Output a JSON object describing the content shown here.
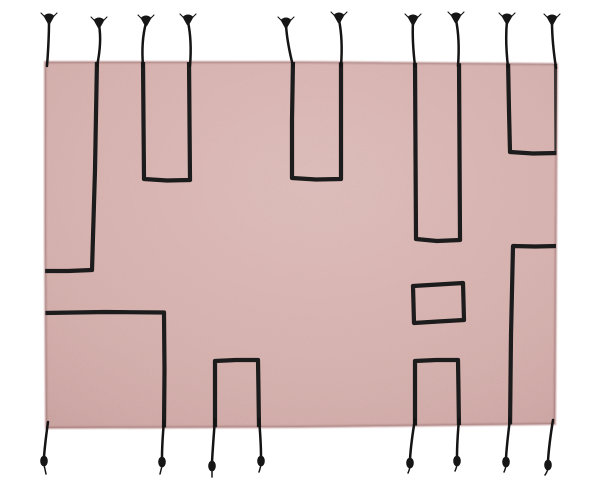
{
  "scene": {
    "description": "Product photograph of a rectangular dusty-pink wool rug with a hand-drawn black geometric line pattern (vertical U-shapes, hooks and a small rectangle) and black braided tassels along the top and bottom edges, on a plain white background",
    "background_color": "#ffffff",
    "rug": {
      "fill_color": "#d8b2af",
      "edge_color": "#c39d9c",
      "shade_color": "#5a2e2e",
      "outline": [
        [
          45,
          62
        ],
        [
          300,
          62
        ],
        [
          557,
          64
        ],
        [
          556,
          240
        ],
        [
          555,
          424
        ],
        [
          300,
          427
        ],
        [
          46,
          428
        ],
        [
          45,
          245
        ]
      ]
    },
    "pattern": {
      "line_color": "#1a1a1a",
      "line_width": 4.2,
      "lines": [
        {
          "name": "left-long-hook",
          "points": [
            [
              97,
              60
            ],
            [
              95,
              170
            ],
            [
              92,
              270
            ],
            [
              68,
              271
            ],
            [
              44,
              271
            ]
          ]
        },
        {
          "name": "u-shape-top-1",
          "points": [
            [
              143,
              60
            ],
            [
              143.5,
              120
            ],
            [
              144,
              179
            ],
            [
              167,
              180.5
            ],
            [
              190,
              180
            ],
            [
              189.5,
              120
            ],
            [
              189,
              60
            ]
          ]
        },
        {
          "name": "u-shape-top-2",
          "points": [
            [
              293,
              60
            ],
            [
              292,
              120
            ],
            [
              292,
              178
            ],
            [
              316,
              179.5
            ],
            [
              341,
              179
            ],
            [
              341,
              120
            ],
            [
              341,
              60
            ]
          ]
        },
        {
          "name": "u-shape-top-3",
          "points": [
            [
              415,
              60
            ],
            [
              415.5,
              150
            ],
            [
              416,
              239
            ],
            [
              437,
              241
            ],
            [
              460,
              240
            ],
            [
              459.5,
              150
            ],
            [
              459,
              60
            ]
          ]
        },
        {
          "name": "top-right-hook",
          "points": [
            [
              508,
              60
            ],
            [
              509,
              110
            ],
            [
              510,
              152
            ],
            [
              533,
              153.5
            ],
            [
              558,
              153
            ]
          ]
        },
        {
          "name": "right-edge-leg",
          "points": [
            [
              556,
              63
            ],
            [
              556.5,
              152
            ]
          ],
          "opacity": 0.8
        },
        {
          "name": "right-mid-hook",
          "points": [
            [
              558,
              246
            ],
            [
              535,
              246.5
            ],
            [
              513,
              246
            ],
            [
              511,
              335
            ],
            [
              510,
              428
            ]
          ]
        },
        {
          "name": "small-rectangle",
          "closed": true,
          "points": [
            [
              413,
              286
            ],
            [
              438,
              284.5
            ],
            [
              463,
              283
            ],
            [
              463.5,
              301
            ],
            [
              464,
              320
            ],
            [
              438,
              321.5
            ],
            [
              414,
              323
            ],
            [
              413.5,
              304
            ]
          ]
        },
        {
          "name": "left-mid-hook",
          "points": [
            [
              44,
              313
            ],
            [
              105,
              312
            ],
            [
              164,
              312.5
            ],
            [
              164.5,
              370
            ],
            [
              164,
              430
            ]
          ]
        },
        {
          "name": "bottom-arch-left",
          "points": [
            [
              215,
              428
            ],
            [
              215,
              390
            ],
            [
              215,
              361
            ],
            [
              236,
              360
            ],
            [
              258,
              360
            ],
            [
              258.5,
              392
            ],
            [
              259,
              428
            ]
          ]
        },
        {
          "name": "bottom-arch-mid",
          "points": [
            [
              415,
              428
            ],
            [
              415,
              390
            ],
            [
              415,
              361
            ],
            [
              436,
              360
            ],
            [
              458,
              360
            ],
            [
              458.5,
              392
            ],
            [
              459,
              428
            ]
          ]
        }
      ]
    },
    "tassels": {
      "color": "#141414",
      "thread_width": 2.5,
      "top": [
        {
          "base_x": 47,
          "base_y": 63,
          "tip_x": 49,
          "tip_y": 17,
          "bend": 2
        },
        {
          "base_x": 97,
          "base_y": 63,
          "tip_x": 99,
          "tip_y": 21,
          "bend": 5
        },
        {
          "base_x": 143,
          "base_y": 63,
          "tip_x": 146,
          "tip_y": 19,
          "bend": -2
        },
        {
          "base_x": 190,
          "base_y": 63,
          "tip_x": 188,
          "tip_y": 18,
          "bend": 2
        },
        {
          "base_x": 293,
          "base_y": 63,
          "tip_x": 286,
          "tip_y": 21,
          "bend": -6
        },
        {
          "base_x": 341,
          "base_y": 63,
          "tip_x": 339,
          "tip_y": 16,
          "bend": 2
        },
        {
          "base_x": 415,
          "base_y": 63,
          "tip_x": 413,
          "tip_y": 18,
          "bend": -3
        },
        {
          "base_x": 458,
          "base_y": 63,
          "tip_x": 456,
          "tip_y": 16,
          "bend": 2
        },
        {
          "base_x": 508,
          "base_y": 64,
          "tip_x": 507,
          "tip_y": 17,
          "bend": -3
        },
        {
          "base_x": 556,
          "base_y": 65,
          "tip_x": 552,
          "tip_y": 18,
          "bend": -4
        }
      ],
      "bottom": [
        {
          "base_x": 48,
          "base_y": 426,
          "knot_x": 44,
          "knot_y": 461,
          "bend": -3,
          "tail_x": 46,
          "tail_y": 474
        },
        {
          "base_x": 164,
          "base_y": 425,
          "knot_x": 162,
          "knot_y": 462,
          "bend": -2,
          "tail_x": 160,
          "tail_y": 474
        },
        {
          "base_x": 215,
          "base_y": 423,
          "knot_x": 212,
          "knot_y": 466,
          "bend": -2,
          "tail_x": 212,
          "tail_y": 477
        },
        {
          "base_x": 259,
          "base_y": 423,
          "knot_x": 261,
          "knot_y": 461,
          "bend": 2,
          "tail_x": 259,
          "tail_y": 472
        },
        {
          "base_x": 415,
          "base_y": 423,
          "knot_x": 410,
          "knot_y": 463,
          "bend": -4,
          "tail_x": 408,
          "tail_y": 473
        },
        {
          "base_x": 459,
          "base_y": 423,
          "knot_x": 457,
          "knot_y": 461,
          "bend": -2,
          "tail_x": 455,
          "tail_y": 471
        },
        {
          "base_x": 510,
          "base_y": 423,
          "knot_x": 506,
          "knot_y": 462,
          "bend": -3,
          "tail_x": 504,
          "tail_y": 472
        },
        {
          "base_x": 553,
          "base_y": 424,
          "knot_x": 548,
          "knot_y": 465,
          "bend": -4,
          "tail_x": 545,
          "tail_y": 475
        }
      ]
    }
  }
}
